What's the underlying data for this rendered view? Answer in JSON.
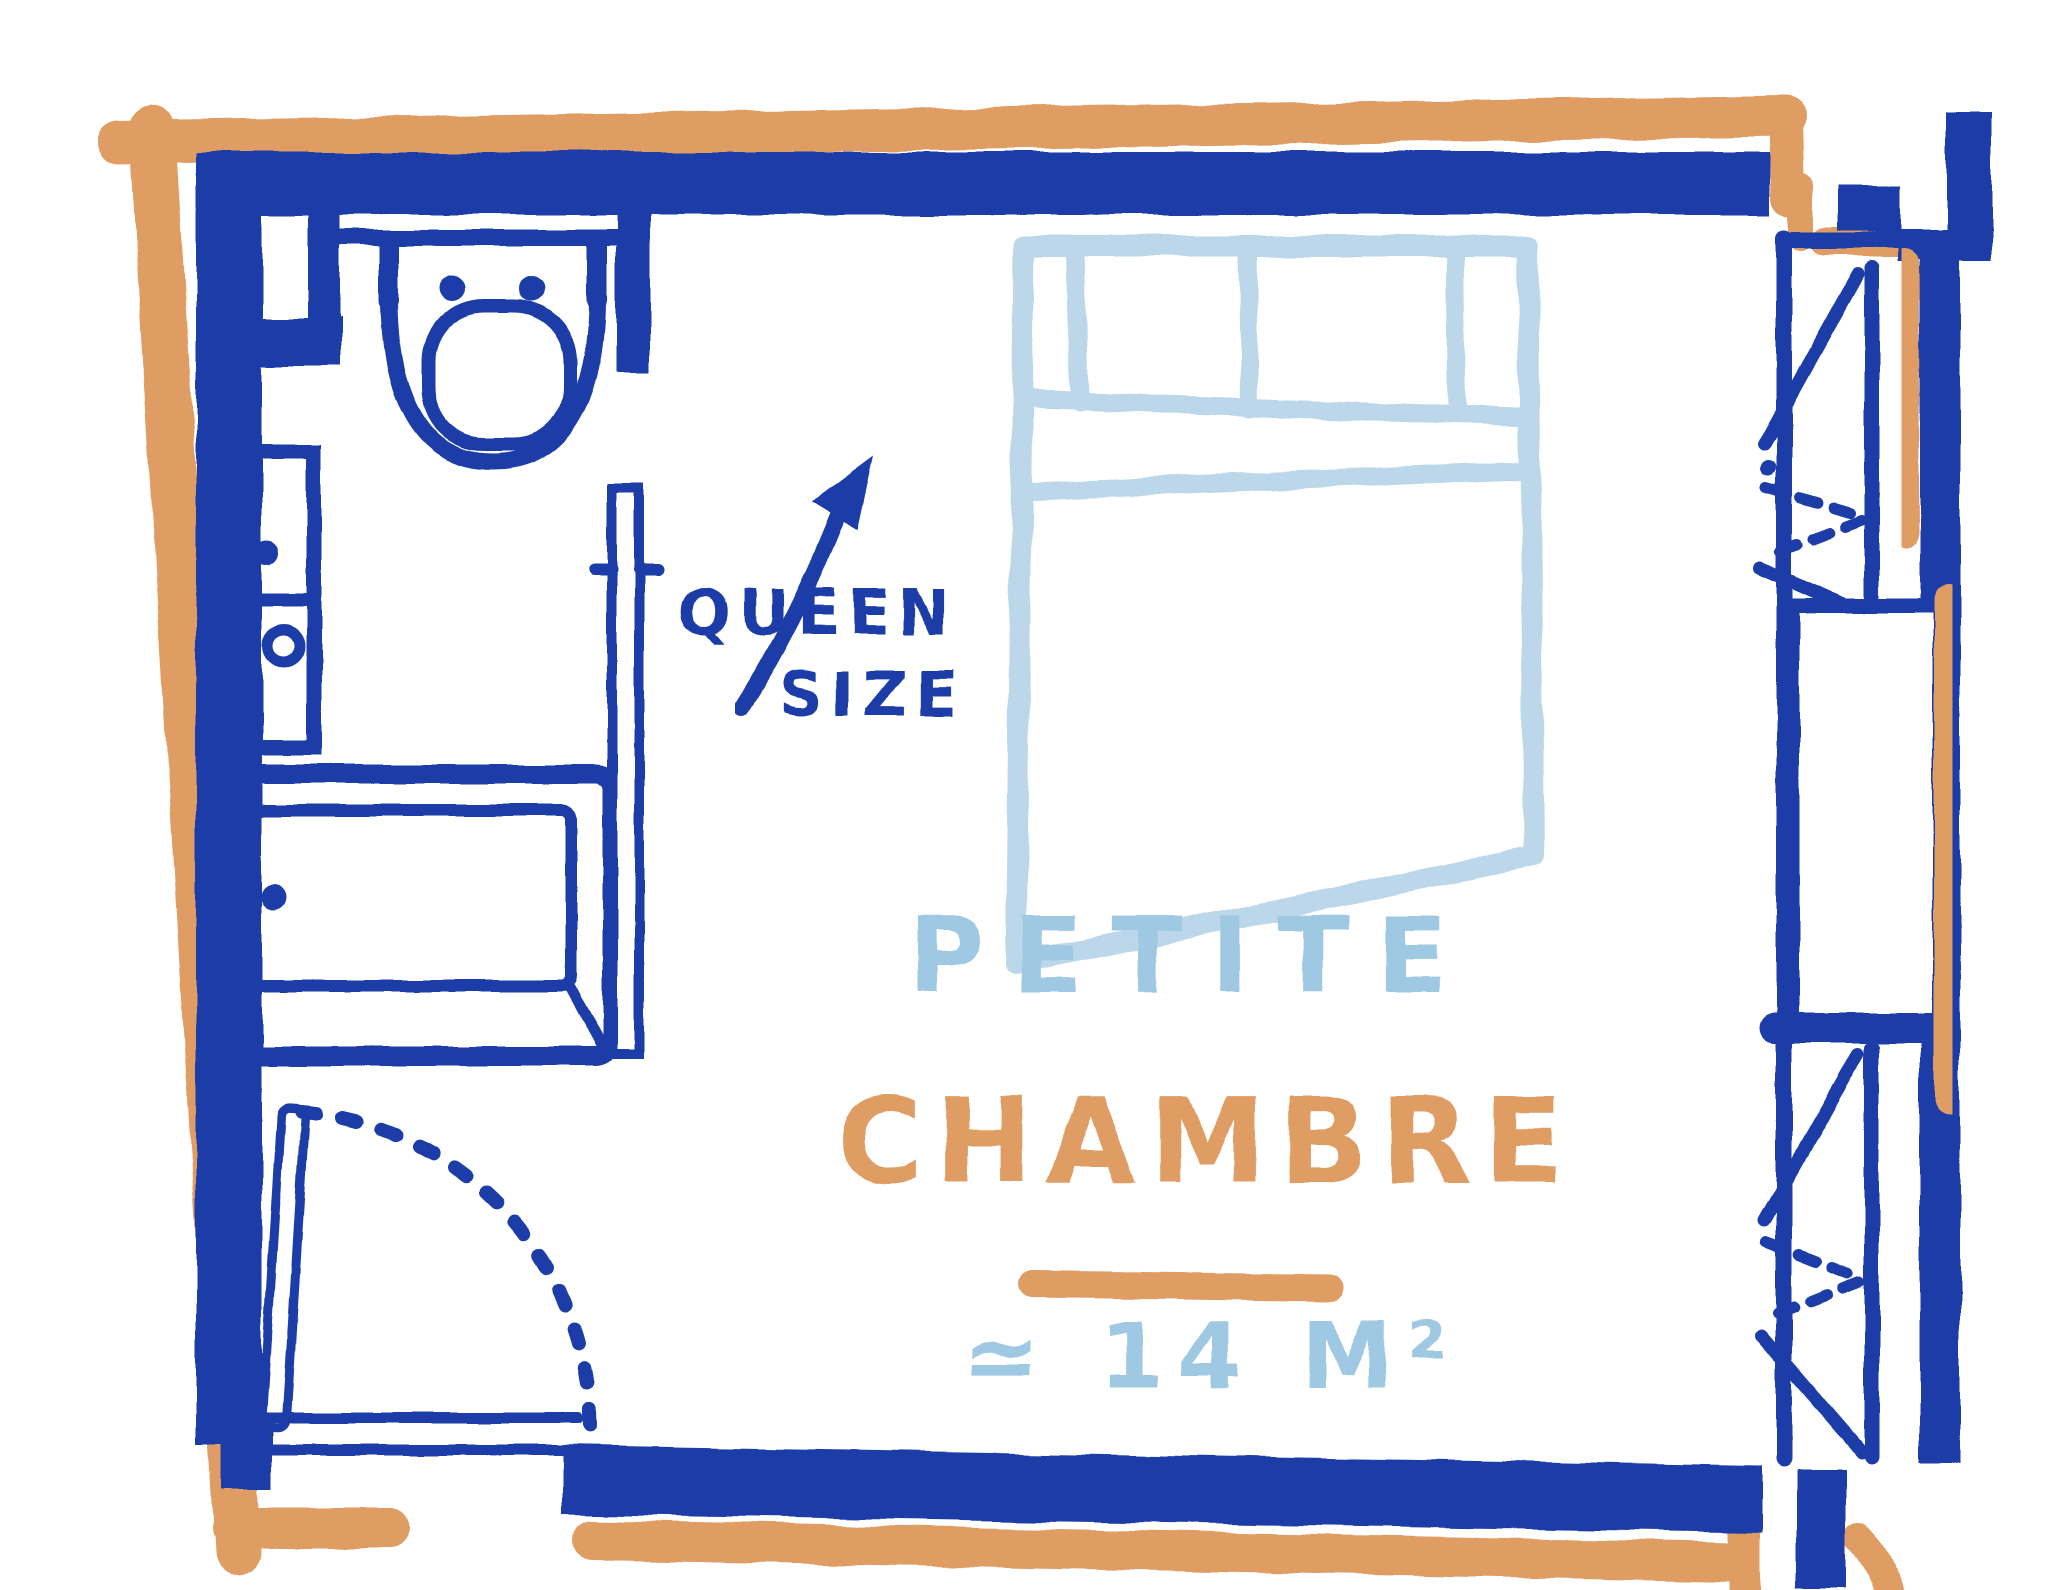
{
  "floor_plan": {
    "type": "hand-drawn bedroom floor plan",
    "rooms": [
      {
        "id": "bathroom",
        "fixtures": [
          "toilet",
          "vanity-cabinet",
          "bathtub",
          "shower-screen"
        ]
      },
      {
        "id": "bedroom",
        "label_line1": "PETITE",
        "label_line2": "CHAMBRE",
        "area": "≃ 14 M²",
        "furniture": [
          "queen-size-bed"
        ]
      },
      {
        "id": "closet",
        "symbols": [
          "wardrobe-triangle-marks",
          "hanging-rod",
          "shelf-compartment"
        ]
      }
    ],
    "annotations": {
      "bed": {
        "line1": "QUEEN",
        "line2": "SIZE",
        "pointer": "curved-arrow-to-bed"
      }
    },
    "door": {
      "style": "hinged",
      "swing_arc": "dashed-quarter-circle",
      "location": "bottom-left"
    },
    "colors": {
      "wall_blue": "#1c3ea8",
      "accent_orange": "#df9c64",
      "bed_light_blue": "#bdd7ea",
      "label_light_blue": "#9fc8e3",
      "background": "#ffffff"
    }
  }
}
